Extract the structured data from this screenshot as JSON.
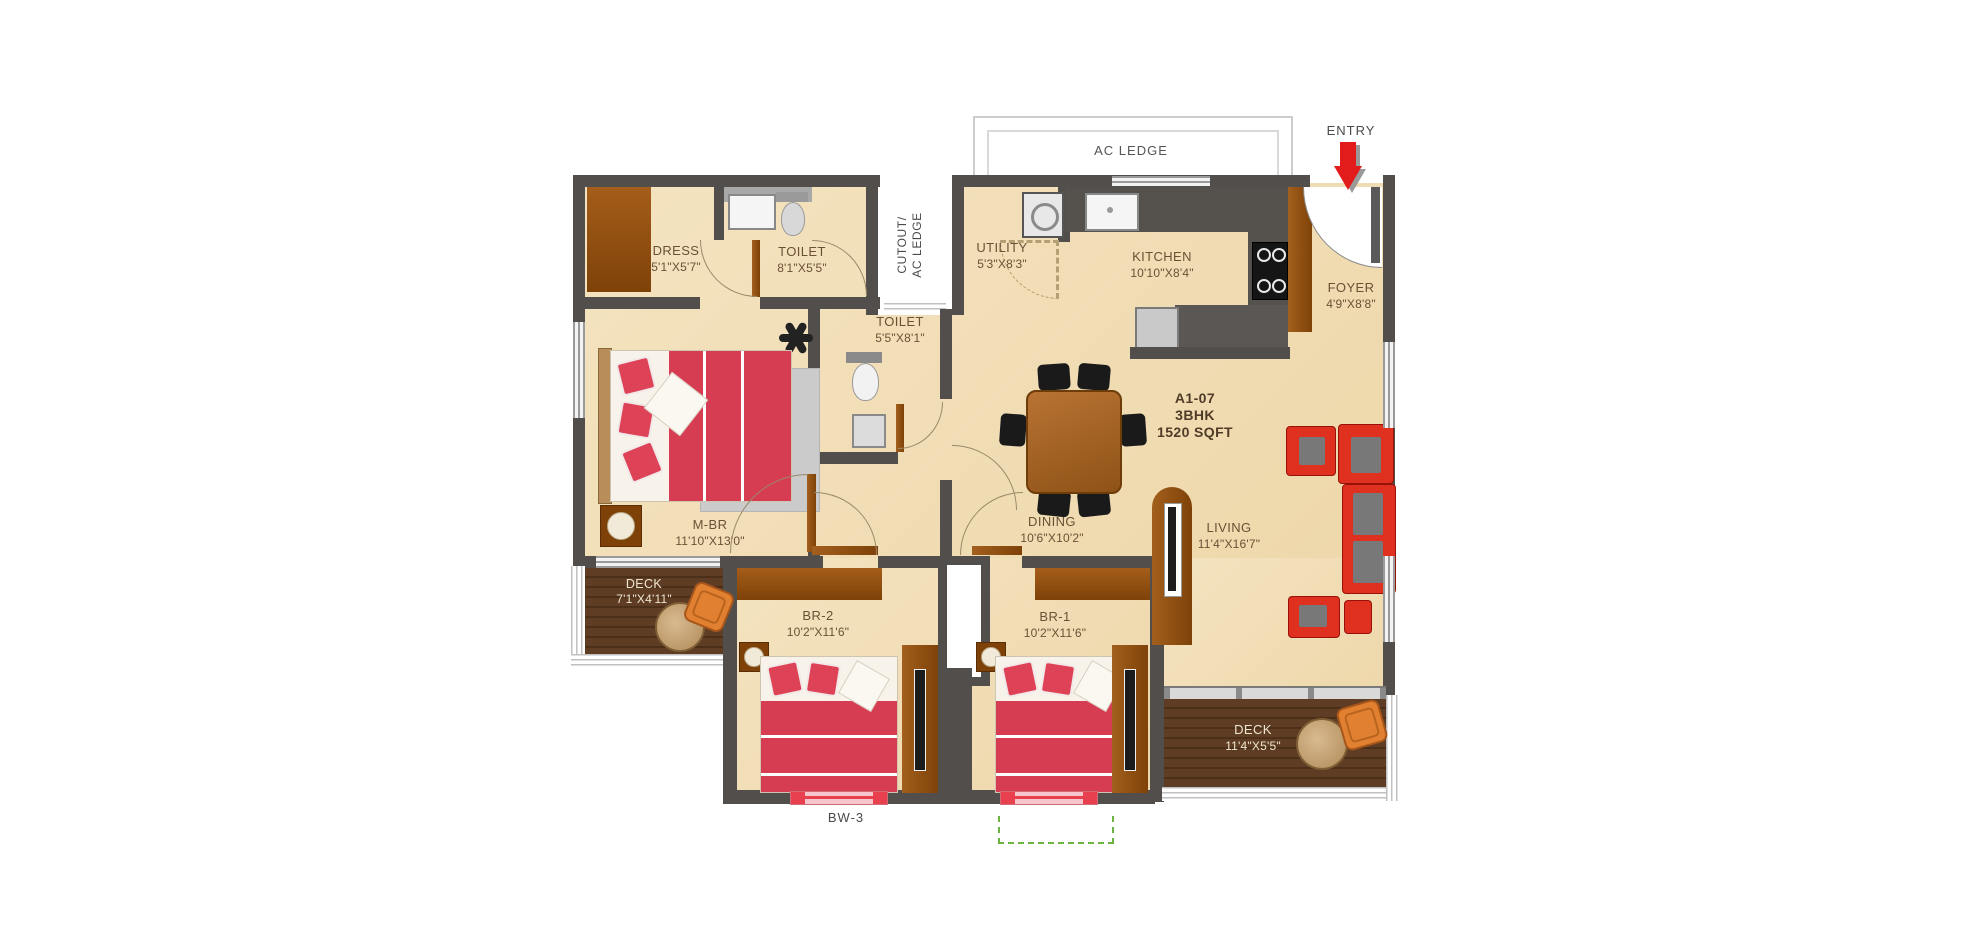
{
  "annotations": {
    "entry": "ENTRY",
    "ac_ledge": "AC LEDGE",
    "cutout_line1": "CUTOUT/",
    "cutout_line2": "AC LEDGE",
    "bw": "BW-3"
  },
  "unit": {
    "code": "A1-07",
    "type": "3BHK",
    "area": "1520 SQFT"
  },
  "rooms": {
    "dress": {
      "name": "DRESS",
      "dims": "5'1\"X5'7\""
    },
    "toilet1": {
      "name": "TOILET",
      "dims": "8'1\"X5'5\""
    },
    "toilet2": {
      "name": "TOILET",
      "dims": "5'5\"X8'1\""
    },
    "utility": {
      "name": "UTILITY",
      "dims": "5'3\"X8'3\""
    },
    "kitchen": {
      "name": "KITCHEN",
      "dims": "10'10\"X8'4\""
    },
    "foyer": {
      "name": "FOYER",
      "dims": "4'9\"X8'8\""
    },
    "mbr": {
      "name": "M-BR",
      "dims": "11'10\"X13'0\""
    },
    "dining": {
      "name": "DINING",
      "dims": "10'6\"X10'2\""
    },
    "living": {
      "name": "LIVING",
      "dims": "11'4\"X16'7\""
    },
    "deck1": {
      "name": "DECK",
      "dims": "7'1\"X4'11\""
    },
    "deck2": {
      "name": "DECK",
      "dims": "11'4\"X5'5\""
    },
    "br2": {
      "name": "BR-2",
      "dims": "10'2\"X11'6\""
    },
    "br1": {
      "name": "BR-1",
      "dims": "10'2\"X11'6\""
    }
  },
  "colors": {
    "wall": "#514e4b",
    "floor": "#f2dfba",
    "deck_wood": "#5f3d25",
    "wardrobe_brown": "#9a5412",
    "bed_red": "#d63c52",
    "sofa_red": "#e0301f",
    "entry_arrow_red": "#e21b1b",
    "marker_green": "#6db33f",
    "window_pink": "#f6c6cc"
  }
}
